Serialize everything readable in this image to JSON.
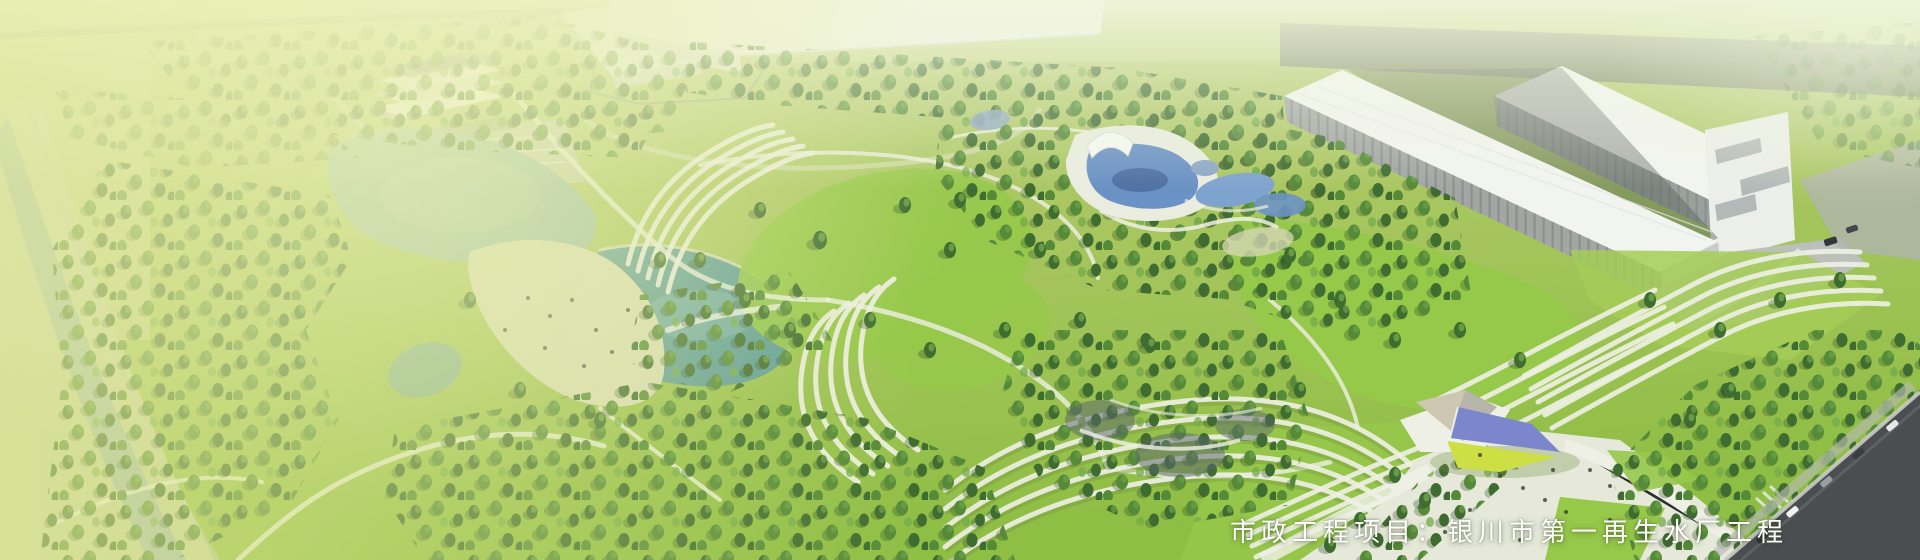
{
  "banner": {
    "caption": "市政工程项目：银川市第一再生水厂工程"
  },
  "palette": {
    "grass_top": "#c4d489",
    "grass_mid": "#a9c75f",
    "grass_deep": "#8cbd41",
    "lawn_bright": "#96c84a",
    "tree_dark": "#3f6c30",
    "tree_mid": "#558a39",
    "tree_light": "#74aa4b",
    "tree_shadow": "#2c4a20",
    "water_teal": "#5f9d99",
    "water_hazed": "#9cbfa9",
    "shore_sand": "#d8dcb6",
    "river_grey": "#a3bbac",
    "bank_pale": "#ccd4a9",
    "path_white": "#eef0e3",
    "plaza_white": "#e6e9da",
    "building_white": "#f2f4f0",
    "building_face": "#9aa09c",
    "building_trim": "#c9cdc9",
    "road_dark": "#4b4e51",
    "road_band": "#767b6e",
    "curb_light": "#c9ccc5",
    "pyramid_blue": "#7c86cd",
    "pyramid_yellow": "#cede45",
    "pyramid_tan": "#cdc7b2",
    "pyramid_grey": "#b7b4a9",
    "pool_blue": "#6b92c4",
    "pool_deep": "#48699c",
    "haze_yellow": "#e2e994",
    "haze_white": "#f2f6de",
    "caption": "#ffffff"
  }
}
